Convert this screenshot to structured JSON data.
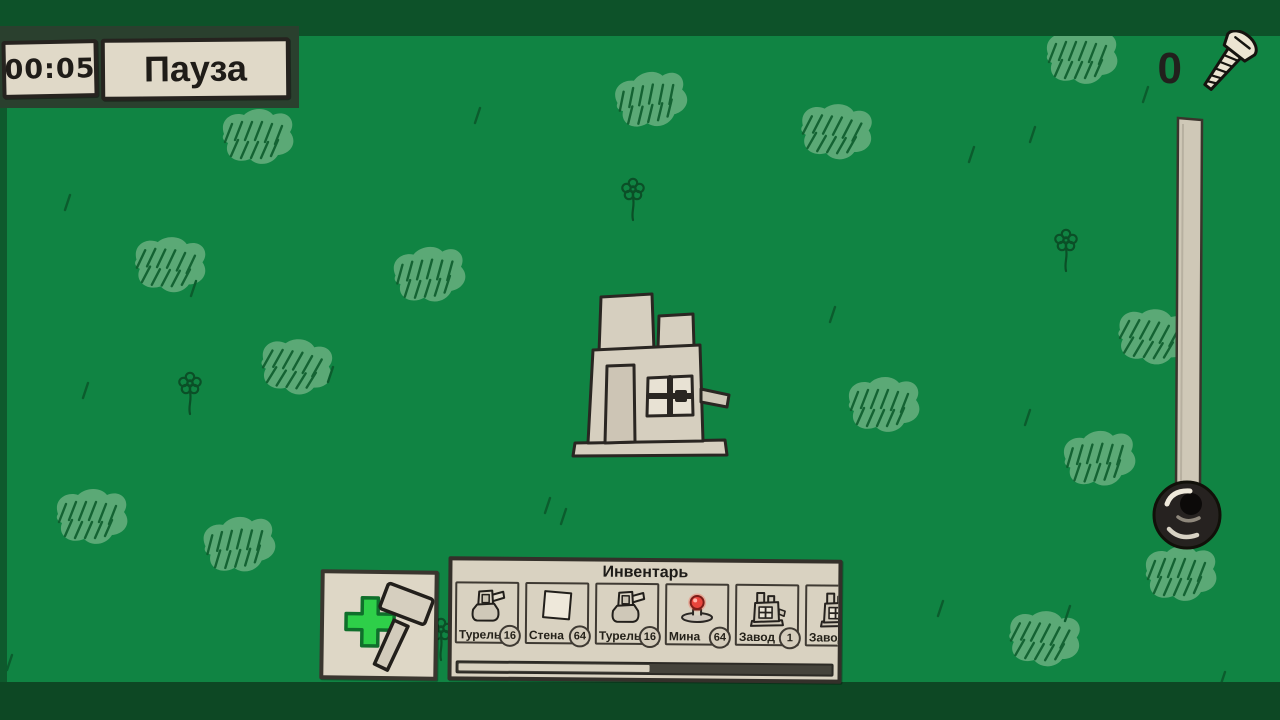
{
  "hud": {
    "timer": "00:05",
    "pause_label": "Пауза",
    "screws": {
      "count": "0",
      "icon": "screw-icon"
    }
  },
  "build_button": {
    "icons": [
      "plus-icon",
      "hammer-icon"
    ]
  },
  "inventory": {
    "title": "Инвентарь",
    "items": [
      {
        "label": "Турель",
        "count": "16",
        "icon": "turret-icon"
      },
      {
        "label": "Стена",
        "count": "64",
        "icon": "wall-icon"
      },
      {
        "label": "Турель",
        "count": "16",
        "icon": "turret-icon"
      },
      {
        "label": "Мина",
        "count": "64",
        "icon": "mine-icon"
      },
      {
        "label": "Завод",
        "count": "1",
        "icon": "factory-icon"
      },
      {
        "label": "Завод",
        "count": "",
        "icon": "factory-icon"
      }
    ],
    "scroll_thumb_percent": 51
  },
  "world": {
    "buildings": [
      {
        "type": "Завод",
        "x": 650,
        "y": 400
      }
    ],
    "lever": {
      "pole_x": 1190,
      "pole_top_y": 118,
      "knob_x": 1187,
      "knob_y": 515
    },
    "decorations": {
      "tufts": [
        [
          258,
          140,
          0
        ],
        [
          652,
          103,
          -10
        ],
        [
          836,
          135,
          6
        ],
        [
          1082,
          60,
          0
        ],
        [
          170,
          268,
          4
        ],
        [
          430,
          278,
          -6
        ],
        [
          296,
          370,
          8
        ],
        [
          884,
          408,
          0
        ],
        [
          1100,
          462,
          -5
        ],
        [
          1153,
          340,
          7
        ],
        [
          92,
          520,
          0
        ],
        [
          240,
          548,
          -7
        ],
        [
          1044,
          642,
          6
        ],
        [
          1181,
          577,
          0
        ]
      ],
      "flowers": [
        [
          633,
          190
        ],
        [
          1066,
          241
        ],
        [
          190,
          384
        ],
        [
          441,
          630
        ]
      ],
      "dashes": [
        [
          70,
          195
        ],
        [
          196,
          281
        ],
        [
          333,
          367
        ],
        [
          88,
          383
        ],
        [
          550,
          498
        ],
        [
          566,
          509
        ],
        [
          974,
          147
        ],
        [
          1035,
          127
        ],
        [
          1148,
          87
        ],
        [
          835,
          307
        ],
        [
          1030,
          410
        ],
        [
          943,
          601
        ],
        [
          1070,
          606
        ],
        [
          1225,
          672
        ],
        [
          12,
          655
        ],
        [
          480,
          108
        ]
      ]
    }
  },
  "colors": {
    "field": "#108443",
    "band_dark": "#0d5229",
    "paper": "#e0d9c8",
    "ink": "#26231f",
    "plus_green": "#2ecf49",
    "mine_red": "#e8453c",
    "tuft_fill": "#6cb181",
    "doodle_stroke": "#0d5c2c"
  }
}
